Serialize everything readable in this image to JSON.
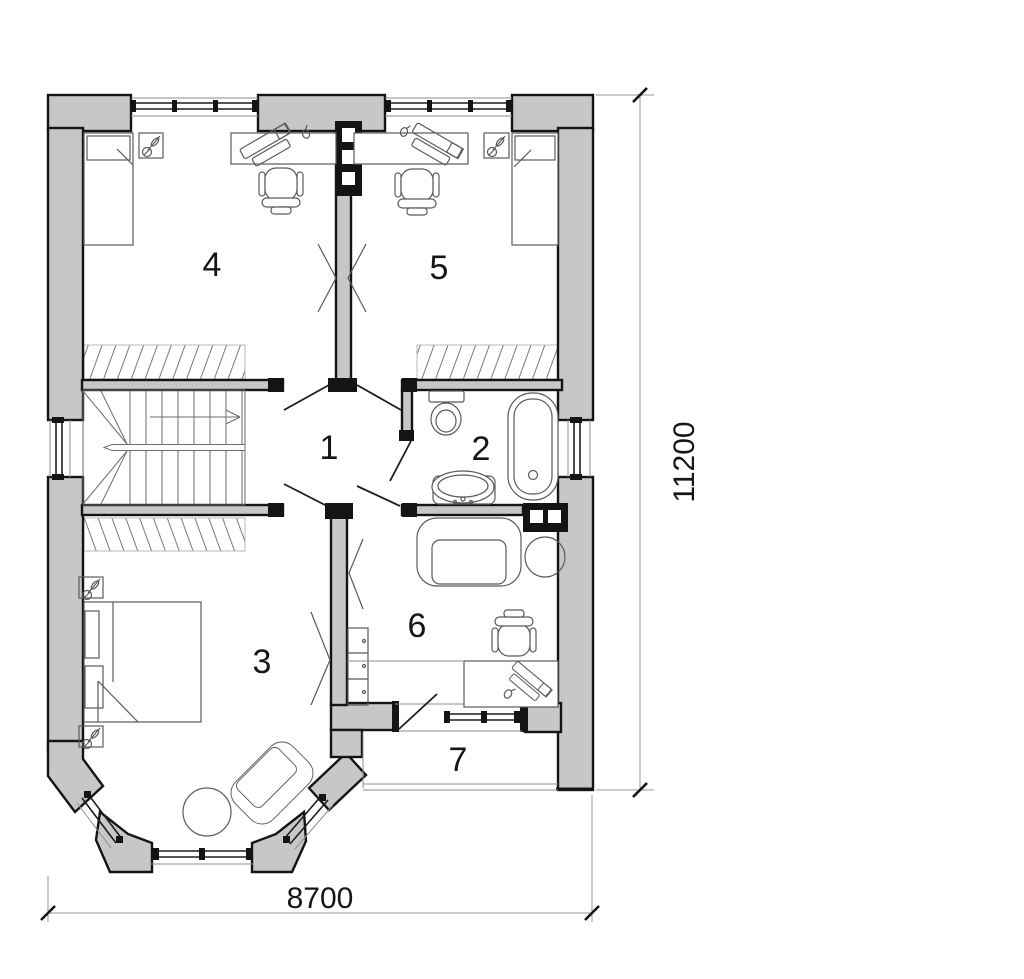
{
  "rooms": {
    "hall": "1",
    "bathroom": "2",
    "bedroom_main": "3",
    "bedroom_left": "4",
    "bedroom_right": "5",
    "study": "6",
    "balcony": "7"
  },
  "dimensions": {
    "overall_width_mm": "8700",
    "overall_height_mm": "11200"
  },
  "colors": {
    "wall_fill": "#c7c7c7",
    "outline": "#141414",
    "furniture_line": "#5a5a5a",
    "thin_line": "#8f8f8f",
    "dimension_line": "#9a9a9a",
    "background": "#ffffff"
  }
}
